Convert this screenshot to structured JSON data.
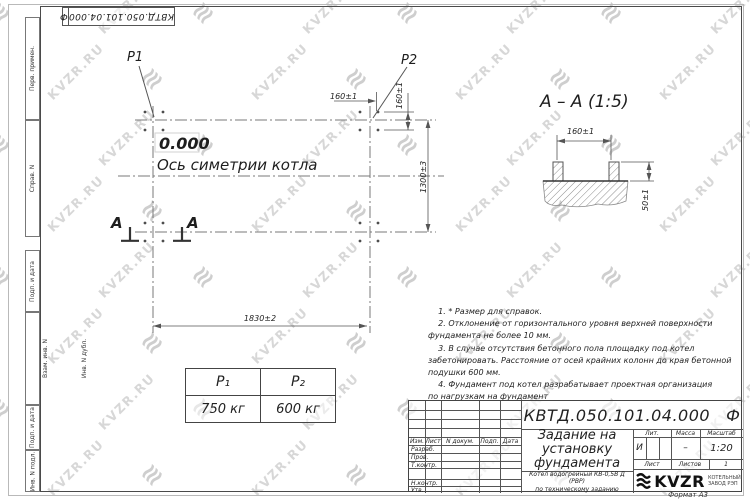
{
  "watermark": {
    "text": "KVZR.RU"
  },
  "corner_stamp": {
    "designation": "КВТД.050.101.04.000",
    "suffix": "Ф"
  },
  "left_column": {
    "cells": [
      "Перв. примен.",
      "Справ. N",
      "Подп. и дата",
      "Взам. инв. N",
      "Инв. N дубл.",
      "Подп. и дата",
      "Инв. N подл."
    ]
  },
  "plan": {
    "p1_label": "Р1",
    "p2_label": "Р2",
    "elevation": "0.000",
    "axis_label": "Ось симетрии котла",
    "dim_width": "1830±2",
    "dim_height": "1300±3",
    "dim_bolt_x": "160±1",
    "dim_bolt_y": "160±1",
    "section_letter": "А"
  },
  "section": {
    "title": "А – А (1:5)",
    "dim_spacing": "160±1",
    "dim_height": "50±1"
  },
  "loads_table": {
    "headers": [
      "Р₁",
      "Р₂"
    ],
    "values": [
      "750 кг",
      "600 кг"
    ]
  },
  "notes": {
    "lines": [
      "    1. * Размер для справок.",
      "    2. Отклонение от горизонтального уровня верхней поверхности",
      "фундамента не более 10 мм.",
      "    3. В случае отсутствия бетонного пола площадку под котел",
      "забетонировать. Расстояние от осей крайних колонн до края бетонной",
      "подушки 600 мм.",
      "    4. Фундамент под котел разрабатывает проектная организация",
      "по нагрузкам на фундамент"
    ]
  },
  "titleblock": {
    "designation": "КВТД.050.101.04.000",
    "suffix": "Ф",
    "doc_title": "Задание на установку фундамента",
    "product_line1": "Котел водогрейный КВ-0,5В Д (РВР)",
    "product_line2": "по техническому заданию",
    "cols": {
      "izm": "Изм.",
      "list": "Лист",
      "doc": "N докум.",
      "podp": "Подп.",
      "data": "Дата"
    },
    "roles": [
      "Разраб.",
      "Пров.",
      "Т.контр.",
      "Н.контр.",
      "Утв."
    ],
    "lit_label": "Лит.",
    "lit_value": "И",
    "mass_label": "Масса",
    "mass_value": "–",
    "scale_label": "Масштаб",
    "scale_value": "1:20",
    "sheet_label": "Лист",
    "sheets_label": "Листов",
    "sheets_value": "1",
    "logo_text": "KVZR",
    "logo_line1": "КОТЕЛЬНЫЙ",
    "logo_line2": "ЗАВОД РЭП",
    "format": "Формат А3"
  }
}
